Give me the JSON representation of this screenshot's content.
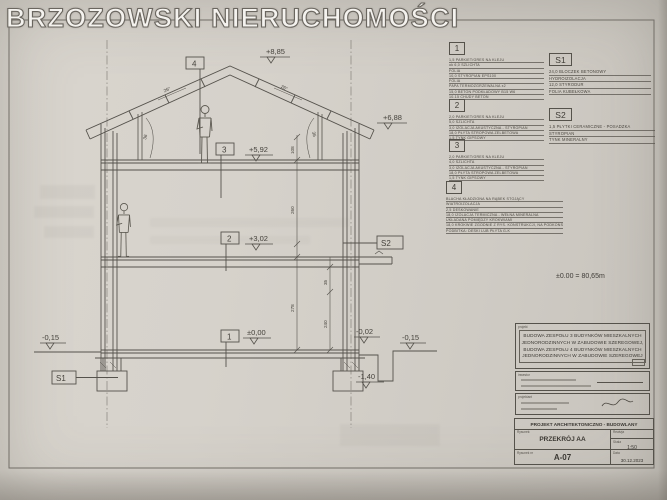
{
  "watermark": "BRZOZOWSKI NIERUCHOMOŚCI",
  "drawing": {
    "levels": {
      "ridge": "+8,85",
      "eaves": "+6,88",
      "attic": "+5,92",
      "floor1": "+3,02",
      "ground": "±0,00",
      "terrain_left": "-0,15",
      "threshold": "-0,02",
      "terrain_right": "-0,15",
      "foundation": "-1,40"
    },
    "labels": {
      "roof": "4",
      "attic": "3",
      "floor1": "2",
      "ground": "1",
      "s1": "S1",
      "s2": "S2"
    },
    "angles": {
      "left": "26°",
      "right": "26°"
    },
    "dims": {
      "knee": "108",
      "attic_room": "260",
      "room": "278",
      "right_upper": "35",
      "right_lower": "240",
      "knee_left": "36",
      "knee_right": "36"
    },
    "datum_note": "±0.00 = 80,65m"
  },
  "legend": {
    "item1": {
      "num": "1",
      "lines": [
        "1,5  PARKIET/GRES NA KLEJU",
        "ok 6,0  SZLICHTA",
        "FOLIA",
        "10,0  STYROPIAN EPS100",
        "FOLIA",
        "PAPA TERMOZGRZEWALNA x2",
        "15,0  BETON PODKŁADOWY B15 W6",
        "10-15  CHUDY BETON"
      ]
    },
    "item2": {
      "num": "2",
      "lines": [
        "2,0  PARKIET/GRES NA KLEJU",
        "5,0  SZLICHTA",
        "3,0  IZOLACJA AKUSTYCZNA - STYROPIAN",
        "18,0  PŁYTA STROPOWA ŻELBETOWA",
        "1,5  TYNK GIPSOWY"
      ]
    },
    "item3": {
      "num": "3",
      "lines": [
        "2,0  PARKIET/GRES NA KLEJU",
        "4,0  SZLICHTA",
        "3,0  IZOLACJA AKUSTYCZNA - STYROPIAN",
        "18,0  PŁYTA STROPOWA ŻELBETOWA",
        "1,5  TYNK GIPSOWY"
      ]
    },
    "item4": {
      "num": "4",
      "lines": [
        "BLACHA KŁADZIONA NA RĄBEK STOJĄCY",
        "WIATROIZOLACJA",
        "2,5  DESKOWANIE",
        "18,0  IZOLACJA TERMICZNA - WEŁNA MINERALNA",
        "UKŁADANA POMIĘDZY KROKWIAMI",
        "18,0  KROKWIE ZGODNIE Z RYS. KONSTRUKCJI, NA PODKONSTRUKCJI",
        "PODBITKA: DESKI LUB PŁYTA G-K"
      ]
    },
    "s1": {
      "num": "S1",
      "lines": [
        "24,0  BLOCZEK BETONOWY",
        "HYDROIZOLACJA",
        "12,0  STYRODUR",
        "FOLIA KUBEŁKOWA"
      ]
    },
    "s2": {
      "num": "S2",
      "lines": [
        "1,5  PŁYTKI CERAMICZNE - POSADZKA",
        "STYROPIAN",
        "TYNK MINERALNY"
      ]
    }
  },
  "titleblock": {
    "project_label": "projekt",
    "project_lines": [
      "BUDOWA ZESPOŁU 3 BUDYNKÓW MIESZKALNYCH",
      "JEDNORODZINNYCH W ZABUDOWIE SZEREGOWEJ,",
      "BUDOWA ZESPOŁU 4 BUDYNKÓW MIESZKALNYCH",
      "JEDNORODZINNYCH W ZABUDOWIE SZEREGOWEJ"
    ],
    "investor_label": "inwestor",
    "designer_label": "projektant",
    "doc_type": "PROJEKT ARCHITEKTONICZNO - BUDOWLANY",
    "drawing_label": "Rysunek:",
    "drawing_title": "PRZEKRÓJ AA",
    "revision_label": "Rewizja",
    "scale_label": "Skala",
    "scale_value": "1:50",
    "number_label": "Rysunek nr",
    "number_value": "A-07",
    "date_label": "Data",
    "date_value": "30.12.2023"
  }
}
